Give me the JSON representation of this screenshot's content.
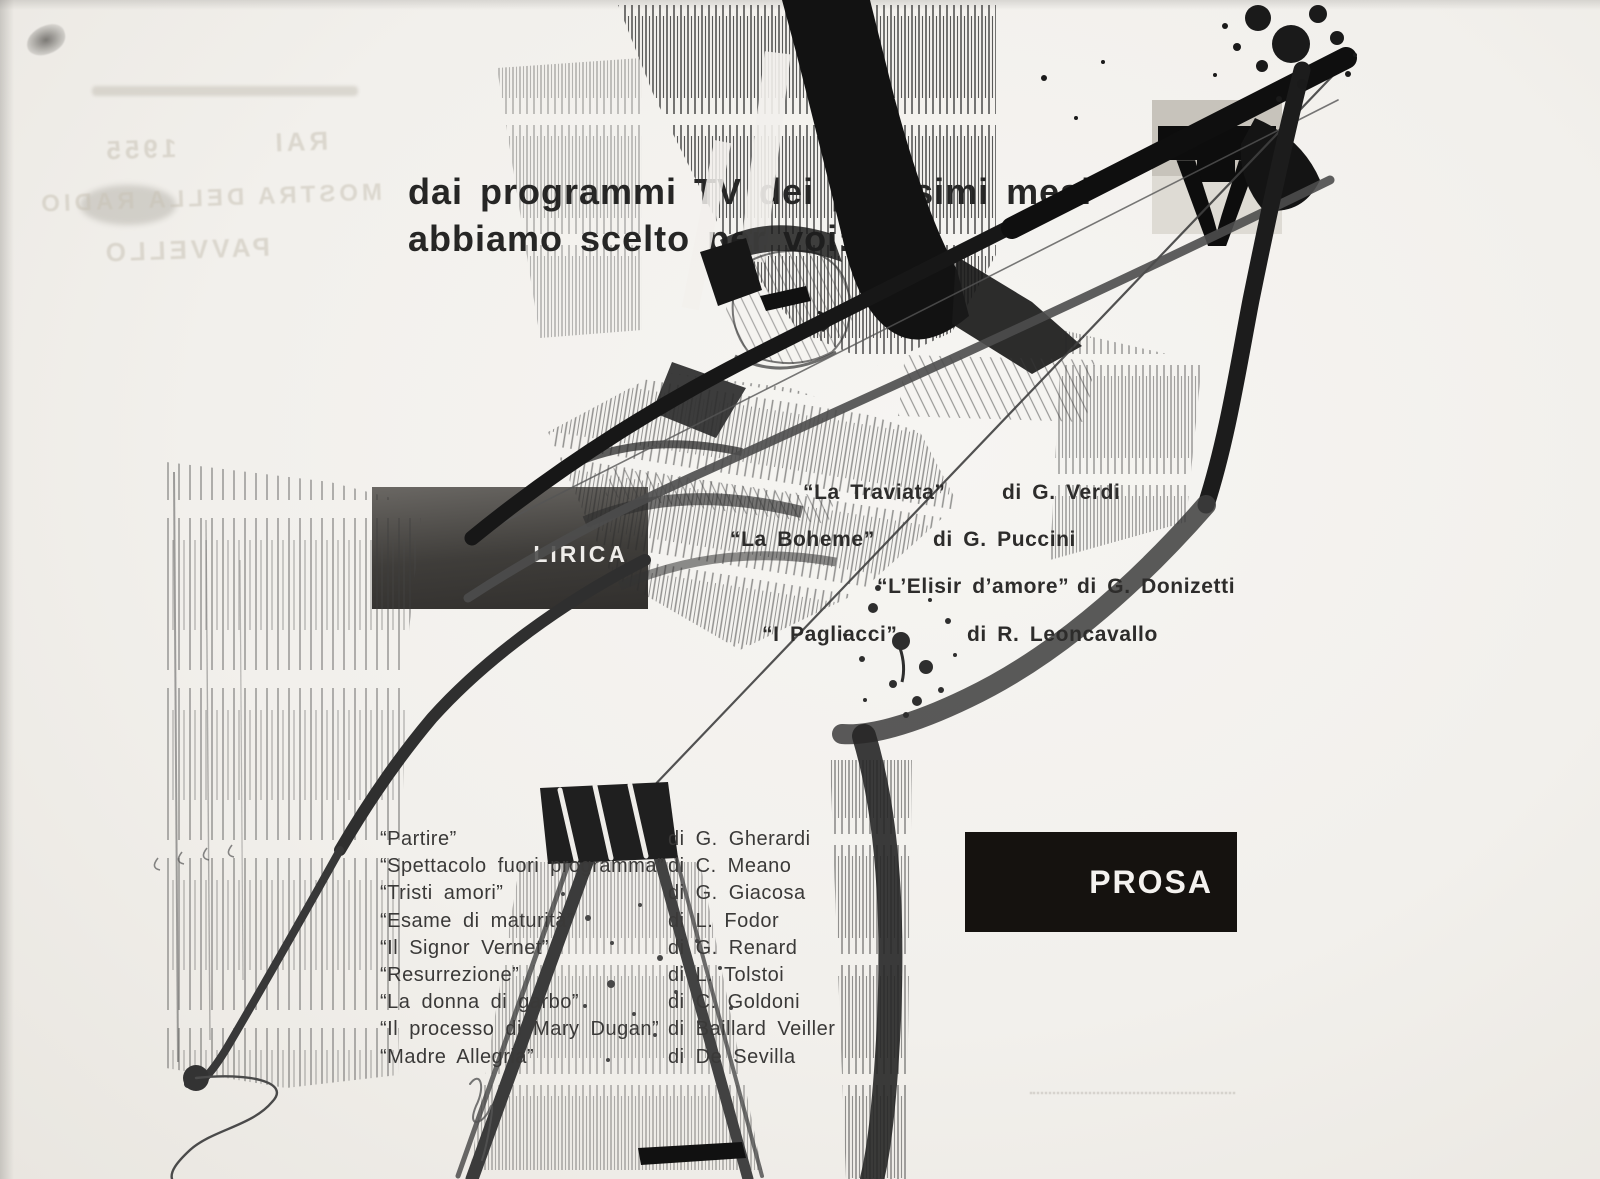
{
  "header": {
    "line1": "dai programmi TV dei prossimi mesi",
    "line2": "abbiamo scelto per voi:"
  },
  "logo": {
    "letter_t": "T",
    "letter_v": "V"
  },
  "sections": [
    {
      "label": "LIRICA",
      "items": [
        {
          "title": "“La Traviata”",
          "author": "di G. Verdi"
        },
        {
          "title": "“La Boheme”",
          "author": "di G. Puccini"
        },
        {
          "title": "“L’Elisir d’amore”",
          "author": "di G. Donizetti"
        },
        {
          "title": "“I Pagliacci”",
          "author": "di R. Leoncavallo"
        }
      ]
    },
    {
      "label": "PROSA",
      "items": [
        {
          "title": "“Partire”",
          "author": "di G. Gherardi"
        },
        {
          "title": "“Spettacolo fuori programma”",
          "author": "di C. Meano"
        },
        {
          "title": "“Tristi amori”",
          "author": "di G. Giacosa"
        },
        {
          "title": "“Esame di maturità”",
          "author": "di L. Fodor"
        },
        {
          "title": "“Il Signor Vernet”",
          "author": "di G. Renard"
        },
        {
          "title": "“Resurrezione”",
          "author": "di L. Tolstoi"
        },
        {
          "title": "“La donna di garbo”",
          "author": "di C. Goldoni"
        },
        {
          "title": "“Il processo di Mary Dugan”",
          "author": "di Baillard Veiller"
        },
        {
          "title": "“Madre Allegria”",
          "author": "di De Sevilla"
        }
      ]
    }
  ],
  "bleedthrough": {
    "line1": "RAI",
    "line2": "1955",
    "line3": "MOSTRA DELLA RADIO",
    "line4": "PAVVELLO"
  },
  "colors": {
    "ink": "#1b1b1b",
    "paper": "#f2f0ec",
    "box_lirica": "#2b2927",
    "box_prosa": "#15120f",
    "text": "#2e2e2e"
  }
}
